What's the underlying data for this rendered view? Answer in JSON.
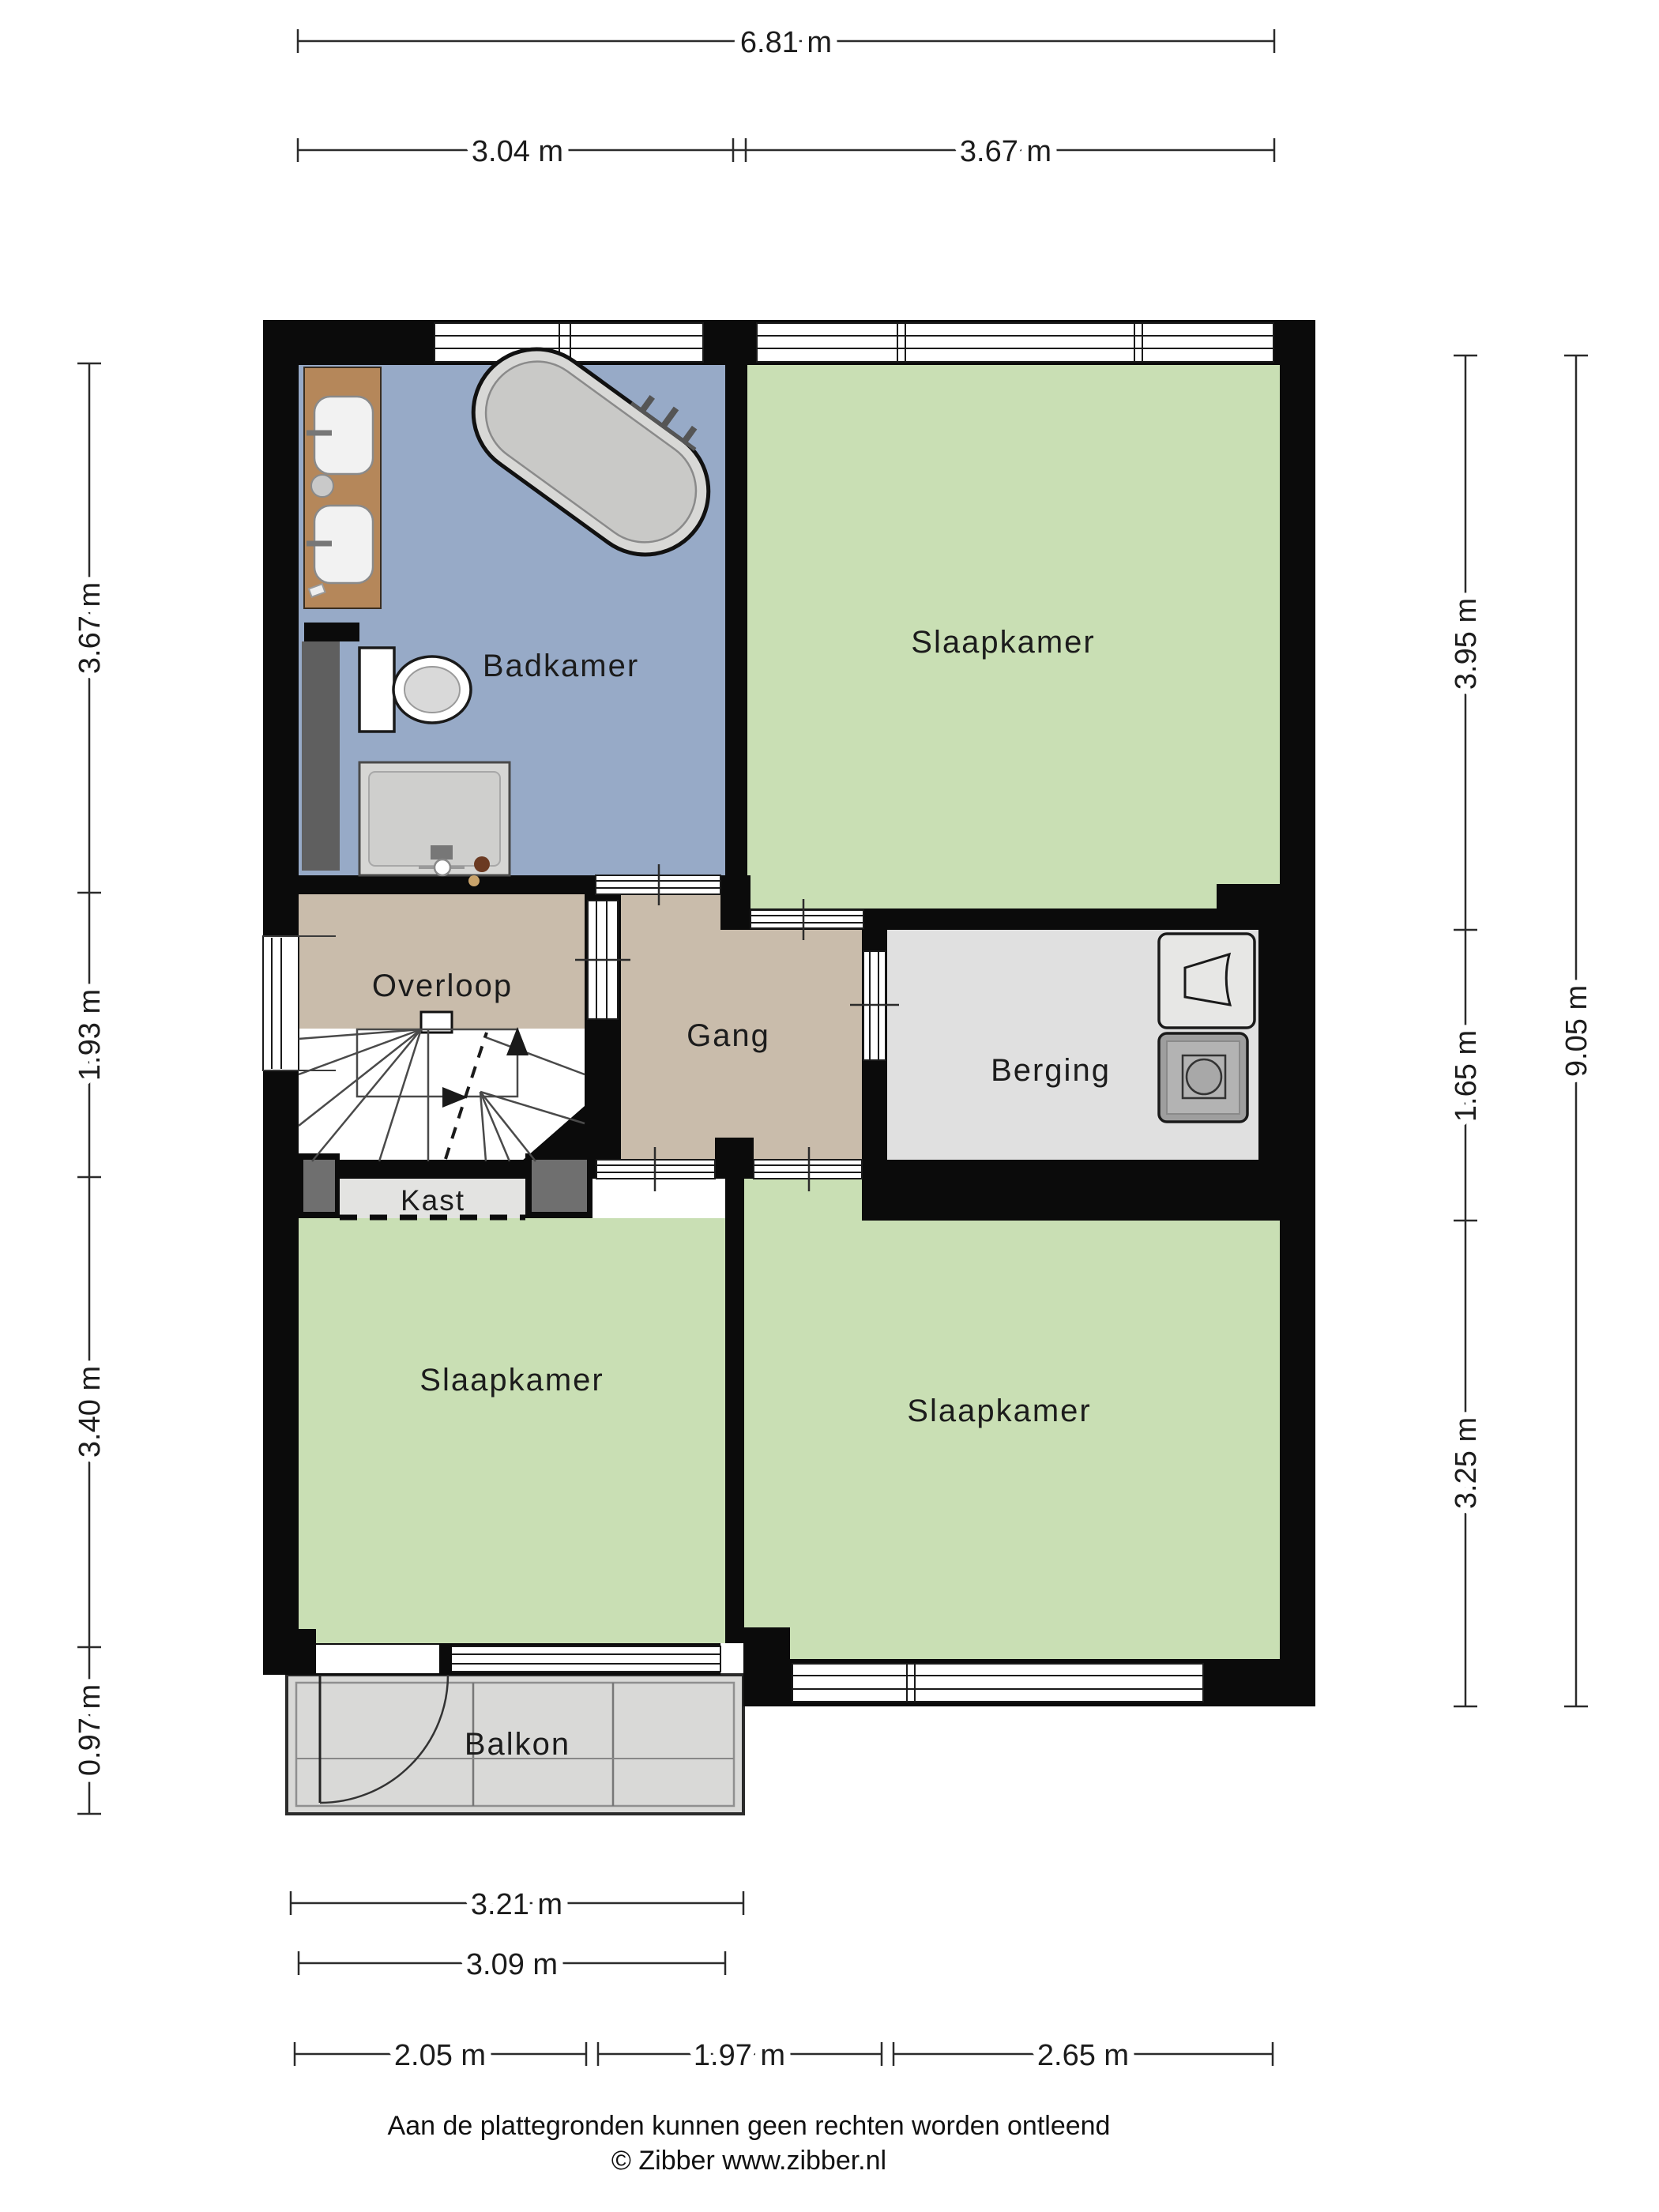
{
  "rooms": {
    "badkamer": {
      "label": "Badkamer"
    },
    "slaapkamer_top": {
      "label": "Slaapkamer"
    },
    "overloop": {
      "label": "Overloop"
    },
    "gang": {
      "label": "Gang"
    },
    "berging": {
      "label": "Berging"
    },
    "kast": {
      "label": "Kast"
    },
    "slaapkamer_left": {
      "label": "Slaapkamer"
    },
    "slaapkamer_right": {
      "label": "Slaapkamer"
    },
    "balkon": {
      "label": "Balkon"
    }
  },
  "dimensions": {
    "top_total": "6.81 m",
    "top_left": "3.04 m",
    "top_right": "3.67 m",
    "left_1": "3.67 m",
    "left_2": "1.93 m",
    "left_3": "3.40 m",
    "left_4": "0.97 m",
    "right_1": "3.95 m",
    "right_2": "1.65 m",
    "right_3": "3.25 m",
    "right_total": "9.05 m",
    "bottom_balkon": "3.21 m",
    "bottom_room": "3.09 m",
    "bottom_1": "2.05 m",
    "bottom_2": "1.97 m",
    "bottom_3": "2.65 m"
  },
  "footer": {
    "disclaimer": "Aan de plattegronden kunnen geen rechten worden ontleend",
    "copyright": "© Zibber www.zibber.nl"
  },
  "colors": {
    "wall": "#0b0b0b",
    "bathroom": "#97aac7",
    "bedroom": "#c9dfb4",
    "hall": "#c9bcab",
    "storage": "#e0e0e0",
    "closet": "#e3e3e1",
    "balcony": "#d9d9d7",
    "wood": "#b5875a"
  }
}
